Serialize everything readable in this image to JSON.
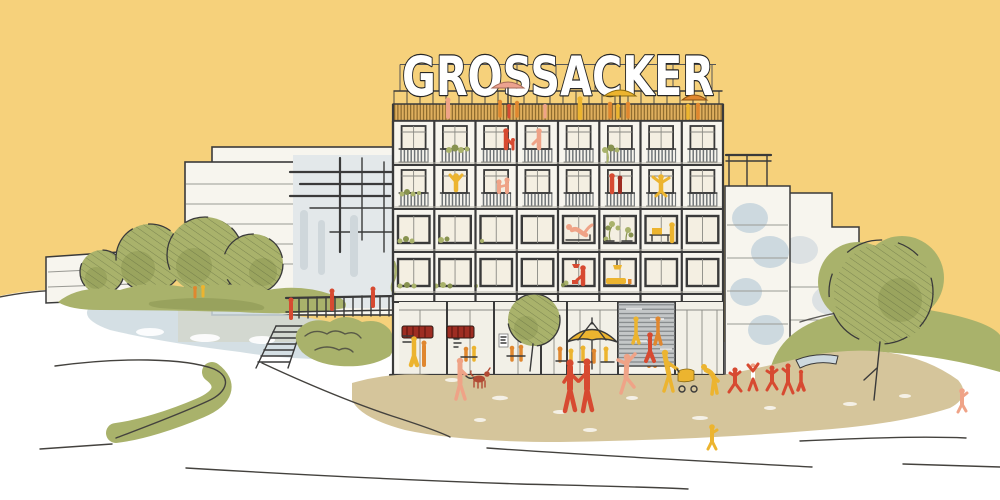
{
  "sign": {
    "text": "GROSSACKER"
  },
  "colors": {
    "sky": "#F6D17B",
    "paper": "#FFFFFF",
    "line": "#3A3A3A",
    "facade": "#F7F5EE",
    "cream": "#F4EFE2",
    "fringe": "#DFAF5E",
    "fringeLine": "#7A5B22",
    "slat": "#6F7477",
    "olive": "#A9B26B",
    "oliveDark": "#87924F",
    "oliveLight": "#BCC07F",
    "blueWash": "#CDD9DF",
    "graySlab": "#E3E8EA",
    "grayLine": "#75797B",
    "louver": "#C4C7C8",
    "plaza": "#D5C59B",
    "red": "#D74A31",
    "darkRed": "#9E2D22",
    "brickRed": "#B14A33",
    "orange": "#E0872F",
    "yellow": "#ECB42F",
    "salmon": "#EFA387",
    "pinkUmbrella": "#ECA28F",
    "glass": "#F2F0E7"
  }
}
